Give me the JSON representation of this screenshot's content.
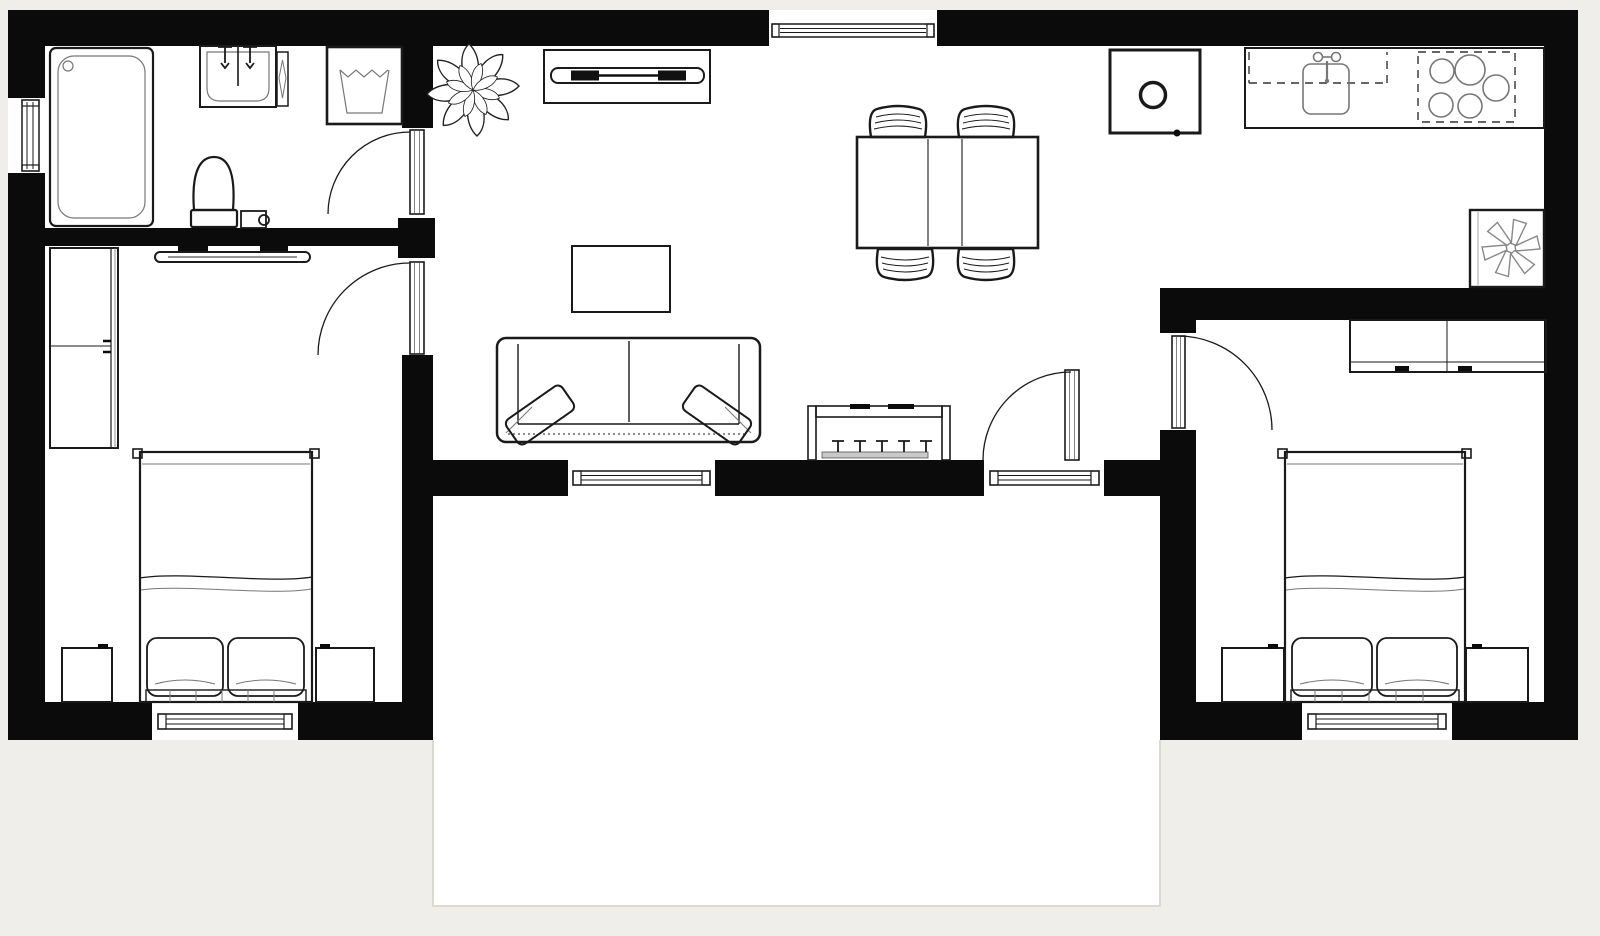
{
  "page": {
    "type": "architectural-floor-plan",
    "background_color": "#f0eeea",
    "wall_color": "#0b0b0b",
    "floor_color": "#ffffff",
    "line_color": "#1a1a1a",
    "terrace_border_color": "#dcd9d3",
    "text_labels": []
  },
  "plan": {
    "style": "black-and-white top-down plan, hand-drawn furniture line style",
    "rooms": [
      {
        "name": "bathroom",
        "position": "top-left",
        "furniture": [
          "bathtub",
          "vanity-sink",
          "faucet-pair",
          "towel-radiator",
          "washing-machine",
          "toilet",
          "toilet-bin",
          "window-left-wall",
          "door-to-living-room"
        ]
      },
      {
        "name": "bedroom-left",
        "position": "left",
        "furniture": [
          "wardrobe",
          "wall-mounted-tv",
          "double-bed",
          "pillow",
          "pillow",
          "nightstand",
          "nightstand",
          "window-bottom-wall",
          "door-to-living-room"
        ]
      },
      {
        "name": "living-room",
        "position": "center",
        "furniture": [
          "potted-plant",
          "tv-cabinet",
          "tv",
          "window-top-wall",
          "dining-table-extendable",
          "dining-chair",
          "dining-chair",
          "dining-chair",
          "dining-chair",
          "coffee-table",
          "sofa-two-seat",
          "throw-pillow",
          "throw-pillow",
          "radiator-bench",
          "window-bottom-wall",
          "terrace-door"
        ]
      },
      {
        "name": "kitchen",
        "position": "top-right",
        "furniture": [
          "oven-column",
          "countertop",
          "kitchen-sink",
          "faucet",
          "cooktop-five-burners",
          "freezer-unit"
        ]
      },
      {
        "name": "bedroom-right",
        "position": "right",
        "furniture": [
          "wardrobe-sliding",
          "double-bed",
          "pillow",
          "pillow",
          "nightstand",
          "nightstand",
          "window-bottom-wall",
          "door-to-living-room"
        ]
      },
      {
        "name": "terrace",
        "position": "bottom-center",
        "furniture": []
      }
    ]
  }
}
